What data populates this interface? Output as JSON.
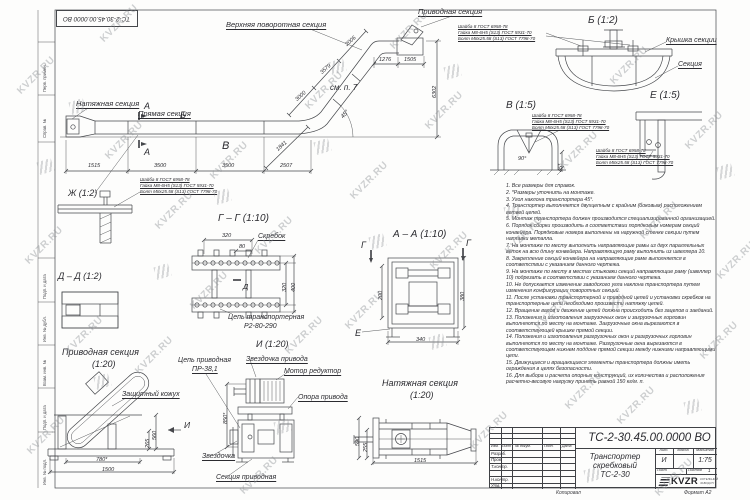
{
  "doc": {
    "number": "ТС-2-30.45.00.0000 ВО",
    "title_line1": "Транспортер",
    "title_line2": "скребковый",
    "title_line3": "ТС-2-30",
    "liter": "И",
    "scale": "1:75",
    "sheet_no": "",
    "sheets_count": "1",
    "copied": "Копировал",
    "format": "Формат А2",
    "logo_text": "KVZR",
    "logo_sub1": "КОТЕЛЬНЫЙ",
    "logo_sub2": "ЗАВОД.РУ"
  },
  "stamp": {
    "h_izm": "Изм.",
    "h_list": "Лист",
    "h_doc": "№ докум.",
    "h_sign": "Подп.",
    "h_date": "Дата",
    "r1": "Разраб.",
    "r2": "Пров.",
    "r3": "Т.контр.",
    "r4": "Н.контр.",
    "r5": "Утв.",
    "lit_h": "Лит.",
    "mass_h": "Масса",
    "scale_h": "Масштаб",
    "sheet_h": "Лист",
    "sheets_h": "Листов"
  },
  "frame_labels": [
    "Перв. примен.",
    "Справ. №",
    "Подп. и дата",
    "Инв. № дубл.",
    "Взам. инв. №",
    "Подп. и дата",
    "Инв. № подл."
  ],
  "watermark": {
    "text": "KVZR.RU"
  },
  "main": {
    "tension": "Натяжная секция",
    "straight": "Прямая секция",
    "upper": "Верхняя поворотная секция",
    "drive": "Приводная секция",
    "see": "см. п. 7"
  },
  "views": {
    "b": "Б (1:2)",
    "v": "В (1:5)",
    "e": "Е (1:5)",
    "zh": "Ж (1:2)",
    "dd": "Д – Д (1:2)",
    "gg": "Г – Г (1:10)",
    "aa": "А – А (1:10)",
    "i": "И (1:20)",
    "drive_t": "Приводная секция",
    "drive_s": "(1:20)",
    "tension_t": "Натяжная секция",
    "tension_s": "(1:20)"
  },
  "parts": {
    "cover": "Крышка секции",
    "section": "Секция",
    "scraper": "Скребок",
    "chain1": "Цепь транспортерная",
    "chain2": "Р2-80-290",
    "dchain1": "Цепь приводная",
    "dchain2": "ПР-38,1",
    "dsprocket": "Звездочка привода",
    "motor": "Мотор редуктор",
    "support": "Опора привода",
    "casing": "Защитный кожух",
    "sprocket": "Звездочка",
    "dsection": "Секция приводная"
  },
  "letters": {
    "a": "А",
    "b": "Б",
    "v": "В",
    "g": "Г",
    "d": "Д",
    "e": "Е",
    "i": "И"
  },
  "callout": {
    "l1": "Шайба 8 ГОСТ 6958-78",
    "l2": "Гайка М8-6Н5 (S13) ГОСТ 5931-70",
    "l3": "Болт М8х25.58 (S13) ГОСТ 7798-70"
  },
  "dims": {
    "d1515": "1515",
    "d3500": "3500",
    "d2507": "2507",
    "d1841": "1841",
    "d3000": "3000",
    "d3579": "3579",
    "d2006": "2006",
    "d1276": "1276",
    "d1505": "1505",
    "d6302": "6302",
    "deg45": "45°",
    "g320": "320",
    "g80": "80",
    "g400": "400",
    "a200": "200",
    "a380": "380",
    "a340": "340",
    "p560": "560",
    "p265": "265",
    "p780": "780*",
    "p1500": "1500",
    "i850": "850*",
    "n590": "590",
    "n255": "255",
    "n1515": "1515",
    "v90": "90°",
    "v45": "45*"
  },
  "notes": [
    "1. Все размеры для справок.",
    "2. *Размеры уточнить на монтаже.",
    "3. Угол наклона транспортера 45°.",
    "4. Транспортер выполняется двухцепным с крайним (боковым) расположением ветвей цепей.",
    "5. Монтаж транспортера должен производится специализированной организацией.",
    "6. Порядок сборки производить в соответствии порядковым номерам секций конвейера. Порядковые номера выполнены на наружной стенке секции путем наплавки металла.",
    "7. На монтаже по месту выполнить направляющие рамы из двух параллельных веток на всю длину конвейера. Направляющую раму выполнить из швеллера 10.",
    "8. Закрепление секций конвейера на направляющие раме выполняется в соответствии с указанием данного чертежа.",
    "9. На монтаже по месту в местах стыковки секций направляющие раму (швеллер 10) подрезать в соответствии с указанием данного чертежа.",
    "10. Не допускается изменение заводского угла наклона транспортера путем изменения конфигурации поворотных секций.",
    "11. После установки транспортерной и приводной цепей и установки скребков на транспортерные цепи необходимо произвести натяжку цепей.",
    "12. Вращение валов и движение цепей должна происходить без зацепов и заеданий.",
    "13. Положения и изготовления загрузочных окон и загрузочных горловин выполняются по месту на монтаже. Загрузочные окна вырезаются в соответствующей крышке прямой секции.",
    "14. Положения и изготовления разгрузочных окон и разгрузочных горловин выполняются по месту на монтаже. Разгрузочные окна вырезаются в соответствующем нижнем поддоне прямой секции между нижними направляющими цепи.",
    "15. Движущиеся и вращающиеся элементы транспортера должны иметь ограждения в целях безопасности.",
    "16. Для выбора и расчета опорных конструкций, их количества и расположения расчетно-весовую нагрузку принять равной 150 кг/м. п."
  ]
}
